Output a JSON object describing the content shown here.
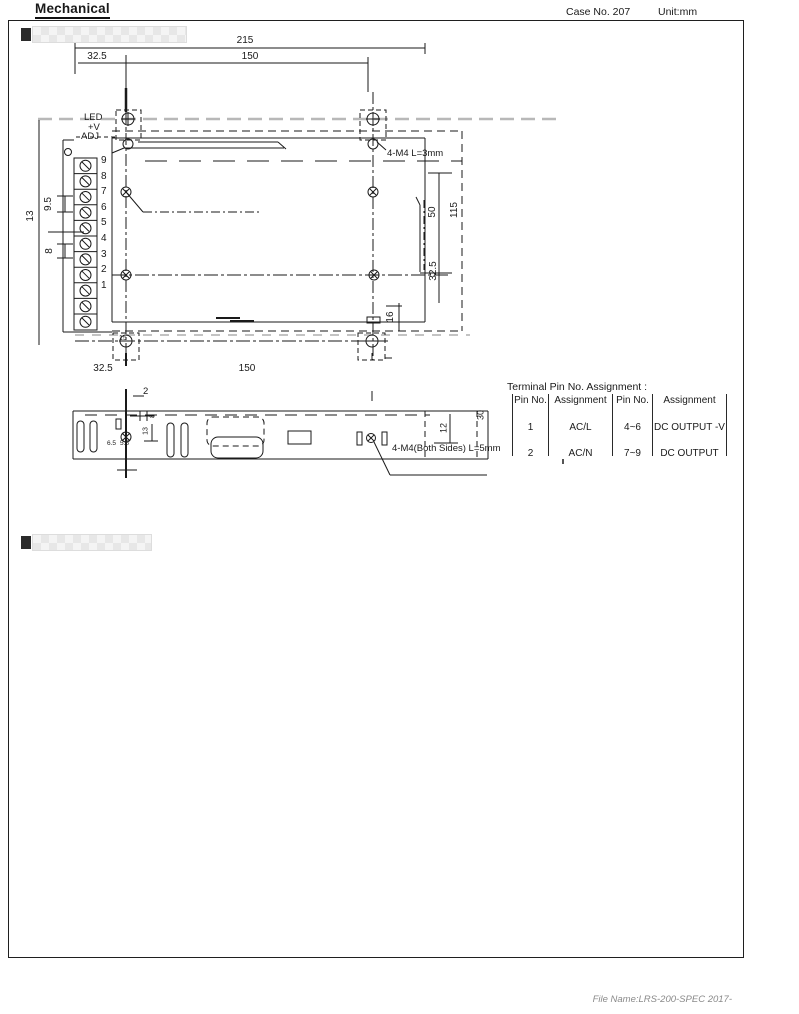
{
  "page": {
    "title": "Mechanical",
    "case_no": "Case No. 207",
    "unit": "Unit:mm",
    "footer": "File Name:LRS-200-SPEC 2017-"
  },
  "top_view": {
    "dims": {
      "width_total": "215",
      "width_left": "32.5",
      "width_holes": "150",
      "bottom_left": "32.5",
      "bottom_holes": "150",
      "depth_50": "50",
      "depth_115": "115",
      "depth_32_5": "32.5",
      "d16": "16",
      "d13": "13",
      "d9_5": "9.5",
      "d8": "8",
      "d15": "15"
    },
    "labels": {
      "led": "LED",
      "plus_v": "+V",
      "adj": "ADJ",
      "screw_note": "4-M4 L=3mm"
    },
    "pins": [
      "9",
      "8",
      "7",
      "6",
      "5",
      "4",
      "3",
      "2",
      "1"
    ]
  },
  "side_view": {
    "dims": {
      "d2": "2",
      "d8": "8",
      "d13": "13",
      "d6_5": "6.5",
      "d5_5": "5.5",
      "d12": "12",
      "d30": "30"
    },
    "screw_note": "4-M4(Both Sides) L=5mm"
  },
  "pin_table": {
    "title": "Terminal Pin No. Assignment :",
    "headers": [
      "Pin No.",
      "Assignment",
      "Pin No.",
      "Assignment"
    ],
    "rows": [
      [
        "1",
        "AC/L",
        "4~6",
        "DC OUTPUT -V"
      ],
      [
        "2",
        "AC/N",
        "7~9",
        "DC OUTPUT"
      ]
    ]
  }
}
